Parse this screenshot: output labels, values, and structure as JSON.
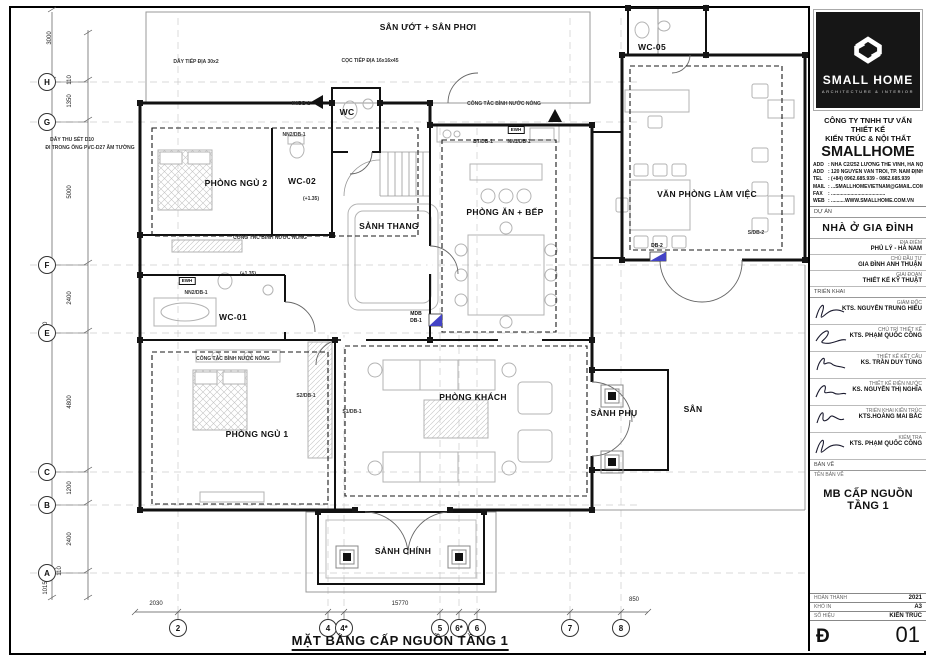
{
  "plan": {
    "title": "MẶT BẰNG CẤP NGUỒN TẦNG 1",
    "labels": [
      {
        "text": "SÂN ƯỚT + SÂN PHƠI",
        "x": 428,
        "y": 27,
        "cls": "room",
        "name": "room-label-san-uot"
      },
      {
        "text": "WC",
        "x": 347,
        "y": 112,
        "cls": "room",
        "name": "room-label-wc"
      },
      {
        "text": "WC-05",
        "x": 652,
        "y": 47,
        "cls": "room",
        "name": "room-label-wc05"
      },
      {
        "text": "PHÒNG NGỦ 2",
        "x": 236,
        "y": 183,
        "cls": "room",
        "name": "room-label-phong-ngu-2"
      },
      {
        "text": "WC-02",
        "x": 302,
        "y": 181,
        "cls": "room",
        "name": "room-label-wc02"
      },
      {
        "text": "SẢNH THANG",
        "x": 389,
        "y": 226,
        "cls": "room",
        "name": "room-label-sanh-thang"
      },
      {
        "text": "PHÒNG ĂN + BẾP",
        "x": 505,
        "y": 212,
        "cls": "room",
        "name": "room-label-phong-an-bep"
      },
      {
        "text": "VĂN PHÒNG LÀM VIỆC",
        "x": 707,
        "y": 194,
        "cls": "room",
        "name": "room-label-van-phong"
      },
      {
        "text": "WC-01",
        "x": 233,
        "y": 317,
        "cls": "room",
        "name": "room-label-wc01"
      },
      {
        "text": "PHÒNG NGỦ 1",
        "x": 257,
        "y": 434,
        "cls": "room",
        "name": "room-label-phong-ngu-1"
      },
      {
        "text": "PHÒNG KHÁCH",
        "x": 473,
        "y": 397,
        "cls": "room",
        "name": "room-label-phong-khach"
      },
      {
        "text": "SẢNH PHỤ",
        "x": 614,
        "y": 413,
        "cls": "room",
        "name": "room-label-sanh-phu"
      },
      {
        "text": "SÂN",
        "x": 693,
        "y": 409,
        "cls": "room",
        "name": "room-label-san"
      },
      {
        "text": "SẢNH CHÍNH",
        "x": 403,
        "y": 551,
        "cls": "room",
        "name": "room-label-sanh-chinh"
      },
      {
        "text": "DÂY TIẾP ĐỊA 30x2",
        "x": 196,
        "y": 62,
        "cls": "ann"
      },
      {
        "text": "CỌC TIẾP ĐỊA 16x16x45",
        "x": 370,
        "y": 61,
        "cls": "ann"
      },
      {
        "text": "IN/DB-1",
        "x": 301,
        "y": 104,
        "cls": "ann"
      },
      {
        "text": "DÂY THU SÉT D10",
        "x": 72,
        "y": 140,
        "cls": "ann"
      },
      {
        "text": "ĐI TRONG ỐNG PVC-D27 ÂM TƯỜNG",
        "x": 90,
        "y": 148,
        "cls": "ann"
      },
      {
        "text": "NN2/DB-1",
        "x": 294,
        "y": 135,
        "cls": "ann"
      },
      {
        "text": "(+1.35)",
        "x": 311,
        "y": 199,
        "cls": "ann"
      },
      {
        "text": "CÔNG TẮC BÌNH NƯỚC NÓNG",
        "x": 270,
        "y": 238,
        "cls": "ann"
      },
      {
        "text": "CÔNG TẮC BÌNH NƯỚC NÓNG",
        "x": 504,
        "y": 104,
        "cls": "ann"
      },
      {
        "text": "BT/DB-1",
        "x": 483,
        "y": 142,
        "cls": "ann"
      },
      {
        "text": "NN1/DB-1",
        "x": 519,
        "y": 142,
        "cls": "ann"
      },
      {
        "text": "NN2/DB-1",
        "x": 196,
        "y": 293,
        "cls": "ann"
      },
      {
        "text": "(+1.35)",
        "x": 248,
        "y": 274,
        "cls": "ann"
      },
      {
        "text": "CÔNG TẮC BÌNH NƯỚC NÓNG",
        "x": 233,
        "y": 359,
        "cls": "ann"
      },
      {
        "text": "S2/DB-1",
        "x": 306,
        "y": 396,
        "cls": "ann"
      },
      {
        "text": "S1/DB-1",
        "x": 352,
        "y": 412,
        "cls": "ann"
      },
      {
        "text": "S/DB-2",
        "x": 756,
        "y": 233,
        "cls": "ann"
      },
      {
        "text": "DB-2",
        "x": 657,
        "y": 246,
        "cls": "tag"
      },
      {
        "text": "MDB",
        "x": 416,
        "y": 314,
        "cls": "tag"
      },
      {
        "text": "DB-1",
        "x": 416,
        "y": 321,
        "cls": "tag"
      },
      {
        "text": "EWH",
        "x": 516,
        "y": 130,
        "cls": "ewh"
      },
      {
        "text": "EWH",
        "x": 187,
        "y": 281,
        "cls": "ewh"
      },
      {
        "text": "3000",
        "x": 50,
        "y": 38,
        "cls": "dim rot"
      },
      {
        "text": "110",
        "x": 70,
        "y": 80,
        "cls": "dim rot"
      },
      {
        "text": "1350",
        "x": 70,
        "y": 101,
        "cls": "dim rot"
      },
      {
        "text": "5000",
        "x": 70,
        "y": 192,
        "cls": "dim rot"
      },
      {
        "text": "2400",
        "x": 70,
        "y": 298,
        "cls": "dim rot"
      },
      {
        "text": "17370",
        "x": 46,
        "y": 330,
        "cls": "dim rot"
      },
      {
        "text": "4800",
        "x": 70,
        "y": 402,
        "cls": "dim rot"
      },
      {
        "text": "1200",
        "x": 70,
        "y": 488,
        "cls": "dim rot"
      },
      {
        "text": "2400",
        "x": 70,
        "y": 539,
        "cls": "dim rot"
      },
      {
        "text": "110",
        "x": 60,
        "y": 571,
        "cls": "dim rot"
      },
      {
        "text": "1015",
        "x": 46,
        "y": 588,
        "cls": "dim rot"
      },
      {
        "text": "2030",
        "x": 156,
        "y": 604,
        "cls": "dim"
      },
      {
        "text": "15770",
        "x": 400,
        "y": 604,
        "cls": "dim"
      },
      {
        "text": "850",
        "x": 634,
        "y": 600,
        "cls": "dim"
      }
    ],
    "grid_left": [
      {
        "t": "H",
        "x": 47,
        "y": 82
      },
      {
        "t": "G",
        "x": 47,
        "y": 122
      },
      {
        "t": "F",
        "x": 47,
        "y": 265
      },
      {
        "t": "E",
        "x": 47,
        "y": 333
      },
      {
        "t": "C",
        "x": 47,
        "y": 472
      },
      {
        "t": "B",
        "x": 47,
        "y": 505
      },
      {
        "t": "A",
        "x": 47,
        "y": 573
      }
    ],
    "grid_bottom": [
      {
        "t": "2",
        "x": 178,
        "y": 628
      },
      {
        "t": "4",
        "x": 328,
        "y": 628
      },
      {
        "t": "4*",
        "x": 344,
        "y": 628
      },
      {
        "t": "5",
        "x": 440,
        "y": 628
      },
      {
        "t": "6*",
        "x": 459,
        "y": 628
      },
      {
        "t": "6",
        "x": 477,
        "y": 628
      },
      {
        "t": "7",
        "x": 570,
        "y": 628
      },
      {
        "t": "8",
        "x": 621,
        "y": 628
      }
    ]
  },
  "title_block": {
    "brand": "SMALL HOME",
    "tagline": "ARCHITECTURE & INTERIOR",
    "company_line1": "CÔNG TY TNHH TƯ VẤN THIẾT KẾ",
    "company_line2": "KIẾN TRÚC & NỘI THẤT",
    "company_name": "SMALLHOME",
    "contacts": [
      {
        "label": "ADD",
        "value": ": NHÀ C2/252 LƯƠNG THẾ VINH, HÀ NỘI"
      },
      {
        "label": "ADD",
        "value": ": 120 NGUYỄN VĂN TRỖI, TP. NAM ĐỊNH"
      },
      {
        "label": "TEL",
        "value": ": (+84) 0962.685.939 - 0862.685.939"
      },
      {
        "label": "MAIL",
        "value": ": ...SMALLHOMEVIETNAM@GMAIL.COM"
      },
      {
        "label": "FAX",
        "value": ": ......................................."
      },
      {
        "label": "WEB",
        "value": ": ..........WWW.SMALLHOME.COM.VN"
      }
    ],
    "project_section": "DỰ ÁN",
    "project_name": "NHÀ Ở GIA ĐÌNH",
    "project_rows": [
      {
        "label": "ĐỊA ĐIỂM",
        "value": "PHỦ LÝ - HÀ NAM"
      },
      {
        "label": "CHỦ ĐẦU TƯ",
        "value": "GIA ĐÌNH ANH THUẬN"
      },
      {
        "label": "GIAI ĐOẠN",
        "value": "THIẾT KẾ KỸ THUẬT"
      }
    ],
    "deploy_section": "TRIỂN KHAI",
    "executors": [
      {
        "role": "GIÁM ĐỐC",
        "name": "KTS. NGUYỄN TRUNG HIẾU"
      },
      {
        "role": "CHỦ TRÌ THIẾT KẾ",
        "name": "KTS. PHẠM QUỐC CÔNG"
      },
      {
        "role": "THIẾT KẾ KẾT CẤU",
        "name": "KS. TRẦN DUY TÙNG"
      },
      {
        "role": "THIẾT KẾ ĐIỆN NƯỚC",
        "name": "KS. NGUYỄN THỊ NGHĨA"
      },
      {
        "role": "TRIỂN KHAI KIẾN TRÚC",
        "name": "KTS.HOÀNG MAI BẮC"
      },
      {
        "role": "KIỂM TRA",
        "name": "KTS. PHẠM QUỐC CÔNG"
      }
    ],
    "drawing_section": "BẢN VẼ",
    "drawing_name_label": "TÊN BẢN VẼ",
    "drawing_name": "MB CẤP NGUỒN TẦNG 1",
    "info_rows": [
      {
        "label": "HOÀN THÀNH",
        "value": "2021"
      },
      {
        "label": "KHỔ IN",
        "value": "A3"
      },
      {
        "label": "SỐ HIỆU",
        "value": "KIẾN TRÚC"
      }
    ],
    "sheet_code": "Đ",
    "sheet_number": "01"
  }
}
